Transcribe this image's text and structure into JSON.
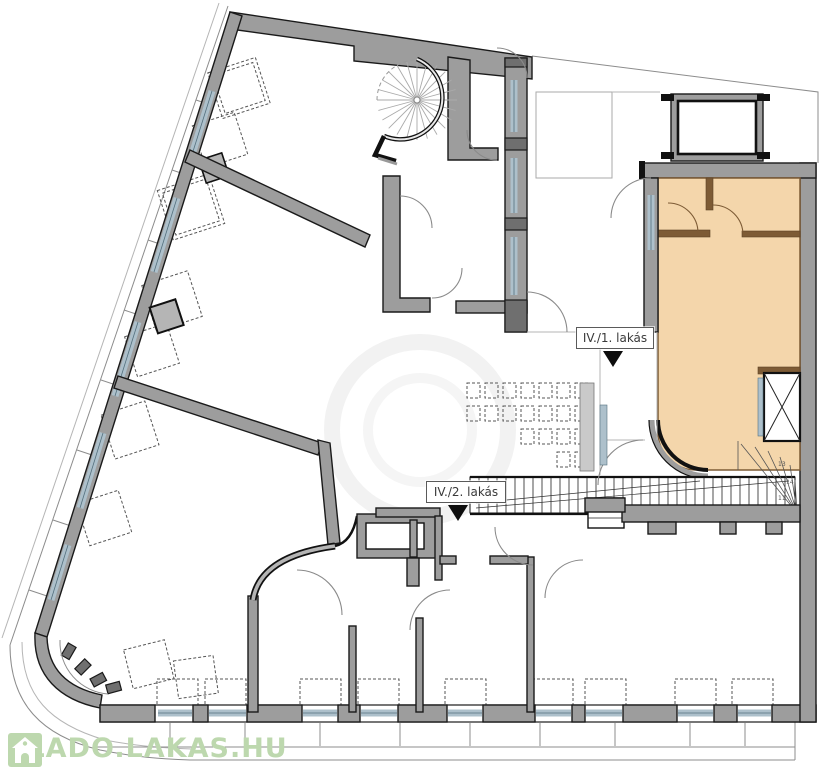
{
  "plan": {
    "unit_labels": [
      {
        "text": "IV./1. lakás"
      },
      {
        "text": "IV./2. lakás"
      }
    ],
    "stair_numbers": [
      "13",
      "14",
      "11"
    ],
    "watermark": {
      "text": "ELADO.LAKAS.HU",
      "icon": "house-icon",
      "color": "#bdd8ae"
    },
    "colors": {
      "wall": "#9d9d9d",
      "wall_outline": "#1a1a1a",
      "highlight": "#f4d6ab",
      "highlight_wall": "#7d5b35",
      "glass": "#adc0cb",
      "watermark_green": "#bdd8ae"
    }
  }
}
